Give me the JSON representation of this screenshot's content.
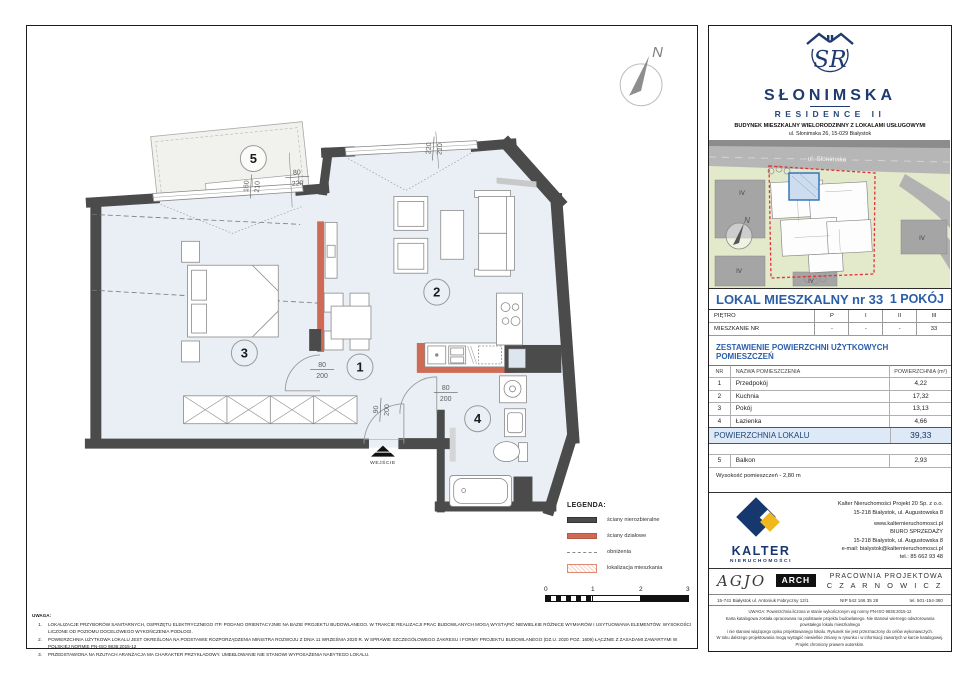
{
  "brand": {
    "monogram": "SR",
    "name": "SŁONIMSKA",
    "subname": "RESIDENCE II",
    "desc1": "BUDYNEK MIESZKALNY WIELORODZINNY Z LOKALAMI USŁUGOWYMI",
    "desc2": "ul. Słonimska 26, 15-029 Białystok"
  },
  "sitemap": {
    "street": "ul. Słonimska",
    "compass": "N",
    "block_labels": [
      "IV",
      "IV",
      "IV",
      "IV"
    ]
  },
  "unit": {
    "title": "LOKAL MIESZKALNY  nr 33",
    "rooms_count": "1 POKÓJ"
  },
  "floor_table": {
    "col0_row1": "PIĘTRO",
    "cols_row1": [
      "P",
      "I",
      "II",
      "III"
    ],
    "col0_row2": "MIESZKANIE NR",
    "cols_row2": [
      "-",
      "-",
      "-",
      "33"
    ]
  },
  "areas": {
    "section_title": "ZESTAWIENIE POWIERZCHNI UŻYTKOWYCH POMIESZCZEŃ",
    "headers": {
      "no": "NR",
      "name": "NAZWA POMIESZCZENIA",
      "area": "POWIERZCHNIA (m²)"
    },
    "rows": [
      {
        "no": "1",
        "name": "Przedpokój",
        "area": "4,22"
      },
      {
        "no": "2",
        "name": "Kuchnia",
        "area": "17,32"
      },
      {
        "no": "3",
        "name": "Pokój",
        "area": "13,13"
      },
      {
        "no": "4",
        "name": "Łazienka",
        "area": "4,66"
      }
    ],
    "total_label": "POWIERZCHNIA LOKALU",
    "total_value": "39,33",
    "balcony_row": {
      "no": "5",
      "name": "Balkon",
      "area": "2,93"
    },
    "height_note": "Wysokość pomieszczeń - 2,80 m"
  },
  "developer": {
    "logo_text": "KALTER",
    "logo_sub": "NIERUCHOMOŚCI",
    "line1": "Kalter Nieruchomości Projekt 20  Sp. z o.o.",
    "line2": "15-218 Białystok, ul. Augustowska 8",
    "line3": "www.kalternieruchomosci.pl",
    "line4": "BIURO SPRZEDAŻY",
    "line5": "15-218 Białystok, ul. Augustowska 8",
    "line6": "e-mail: bialystok@kalternieruchomosci.pl",
    "line7": "tel.: 85 662 93 48"
  },
  "studio": {
    "agjo": "AGJO",
    "arch": "ARCH",
    "title1": "PRACOWNIA PROJEKTOWA",
    "title2": "C Z A R N O W I C Z",
    "address": "15-741 Białystok    ul. Antoniuk Fabryczny  12/1",
    "nip": "NIP   542 166 35 28",
    "tel": "tel. 501-154-380"
  },
  "fine_print": {
    "line1": "UWAGA:   Powierzchnia liczona w stanie wykończonym wg normy PN-ISO 9836:2015-12",
    "line2": "Karta katalogowa została opracowana na podstawie projektu budowlanego.  Nie stanowi wiernego odwzorowania powstałego lokalu mieszkalnego",
    "line3": "i nie stanowi wiążącego opisu projektowanego lokalu. Rysunek nie jest przeznaczony do celów wykonawczych.",
    "line4": "W toku dalszego projektowania mogą wystąpić niewielkie zmiany w rysunku i w informacji zawartych w karcie katalogowej. Projekt chroniony prawem autorskim."
  },
  "plan": {
    "compass": "N",
    "entrance": "WEJŚCIE",
    "rooms": {
      "r1": "1",
      "r2": "2",
      "r3": "3",
      "r4": "4",
      "r5": "5"
    },
    "dims": {
      "balcony_win": {
        "num": "160",
        "den": "210"
      },
      "balcony_door": {
        "num": "80",
        "den": "220"
      },
      "living_win": {
        "num": "220",
        "den": "210"
      },
      "bedroom_door": {
        "num": "80",
        "den": "200"
      },
      "entrance_door": {
        "num": "90",
        "den": "200"
      },
      "bath_door": {
        "num": "80",
        "den": "200"
      }
    }
  },
  "legend": {
    "title": "LEGENDA:",
    "item1": "ściany nierozbieralne",
    "item2": "ściany działowe",
    "item3": "obniżenia",
    "item4": "lokalizacja mieszkania"
  },
  "scalebar": {
    "t0": "0",
    "t1": "1",
    "t2": "2",
    "t3": "3"
  },
  "notes": {
    "title": "UWAGA:",
    "n1": "1.",
    "t1": "LOKALIZACJE PRZYBORÓW SANITARNYCH, OSPRZĘTU ELEKTRYCZNEGO ITP. PODANO ORIENTACYJNIE NA BAZIE PROJEKTU BUDOWLANEGO. W TRAKCIE REALIZACJI PRAC BUDOWLANYCH MOGĄ WYSTĄPIĆ NIEWIELKIE RÓŻNICE WYMIARÓW I USYTUOWANIA ELEMENTÓW. WYSOKOŚCI LICZONE OD POZIOMU DOCELOWEGO WYKOŃCZENIA PODŁOGI.",
    "n2": "2.",
    "t2": "POWIERZCHNIA UŻYTKOWA LOKALU JEST OKREŚLONA NA PODSTAWIE ROZPORZĄDZENIA MINISTRA ROZWOJU Z DNIA 11 WRZEŚNIA 2020 R. W SPRAWIE SZCZEGÓŁOWEGO ZAKRESU I FORMY PROJEKTU BUDOWLANEGO (DZ.U. 2020 POZ. 1609) ŁĄCZNIE Z ZASADAMI ZAWARTYMI W POLSKIEJ NORMIE PN-ISO 9836:2015-12",
    "n3": "3.",
    "t3": "PRZEDSTAWIONA NA RZUTACH ARANŻACJA MA CHARAKTER PRZYKŁADOWY. UMEBLOWANIE NIE STANOWI WYPOSAŻENIA NABYTEGO LOKALU."
  },
  "colors": {
    "wall": "#4b4b4b",
    "partition": "#cf6a55",
    "floor_fill": "#e9eff5",
    "brand_navy": "#1e3a6e",
    "table_blue": "#2a5ea9",
    "kalter_blue": "#16386e",
    "kalter_yellow": "#f0b81e",
    "site_highlight_red": "#e03333",
    "unit_highlight_blue": "#2a6db5"
  }
}
